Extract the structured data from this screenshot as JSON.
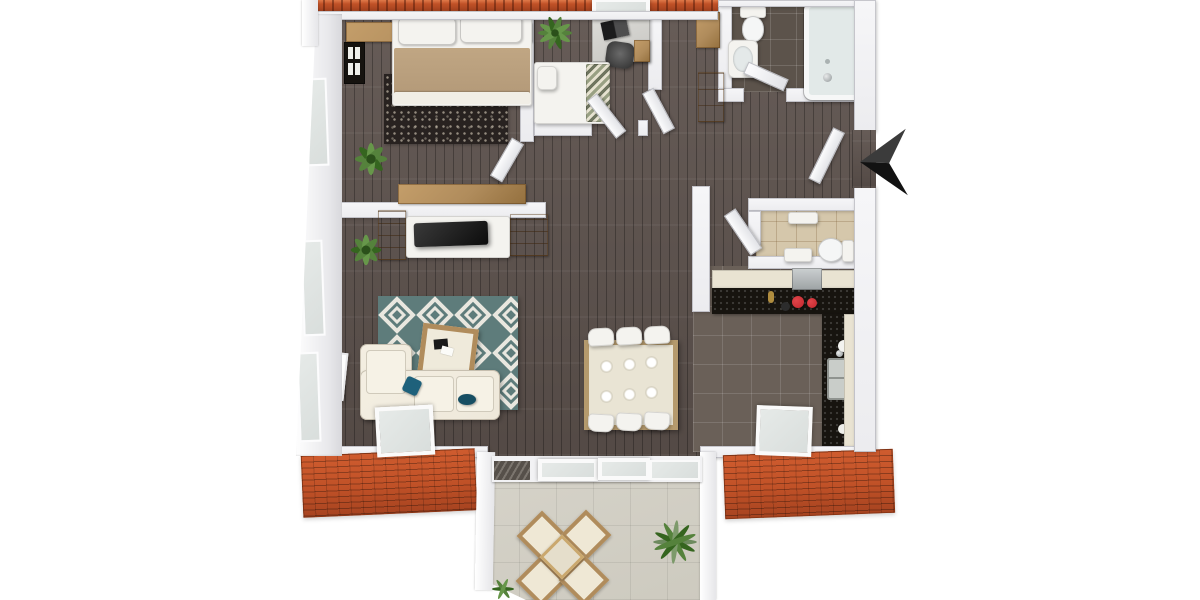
{
  "scene": {
    "type": "3d-floor-plan-render",
    "view": "top-down",
    "description": "3D rendered floor plan of an apartment with master bedroom, second bedroom with desk, hallway with wardrobes, bathroom with tub, separate WC, open kitchen with L-shaped black counter, open living-dining area and a tiled roof terrace with seating"
  },
  "colors": {
    "background": "#ffffff",
    "roof": "#c05127",
    "wall": "#ececef",
    "wood_floor": "#5d524d",
    "tile_bath": "#5c534b",
    "tile_kitchen": "#6a6058",
    "tile_wc": "#d5c7ab",
    "terrace_floor": "#cdcabf",
    "rug_teal": "#5e7c7b",
    "rug_cream": "#e9e7df",
    "rug_dark": "#282220",
    "sofa_cream": "#eee8da",
    "pillow_teal": "#1e617b",
    "blanket_tan": "#b49a79",
    "wood_furniture": "#b08c5c",
    "counter_black": "#17140f",
    "cabinet_cream": "#e9e3d2",
    "appliance_red": "#c2272d",
    "glass": "#d9dedc",
    "plant_green": "#55823c",
    "plant_green_dark": "#35651f",
    "plant_green_light": "#67974a",
    "arrow_black": "#121212",
    "art_pink": "#d4527e"
  },
  "rooms": [
    {
      "id": "bedroom-main",
      "floor": "dark-wood",
      "items": [
        "double-bed",
        "two-pillows",
        "tan-blanket",
        "black-white-patterned-rug",
        "wood-headboard-band",
        "wall-window-art",
        "plant",
        "sideboard"
      ]
    },
    {
      "id": "bedroom-2",
      "floor": "dark-wood",
      "items": [
        "single-bed",
        "zigzag-blanket",
        "desk",
        "laptop",
        "desk-chair",
        "drawer-unit",
        "plant"
      ]
    },
    {
      "id": "hallway",
      "floor": "dark-wood",
      "items": [
        "wardrobe-cabinet-upper",
        "wardrobe-cabinet-lower"
      ]
    },
    {
      "id": "bathroom",
      "floor": "dark-grey-tile",
      "items": [
        "toilet",
        "washbasin",
        "bathtub",
        "open-door"
      ]
    },
    {
      "id": "entrance",
      "floor": "dark-wood",
      "items": [
        "open-entrance-door",
        "entrance-direction-arrow"
      ]
    },
    {
      "id": "wc",
      "floor": "beige-tile",
      "items": [
        "toilet",
        "washbasin",
        "shelf",
        "open-door"
      ]
    },
    {
      "id": "kitchen",
      "floor": "grey-tile",
      "items": [
        "cream-cabinet-run",
        "black-countertop",
        "extractor-hood",
        "cooktop-with-red-pots",
        "side-counter-with-sink",
        "tall-cream-cabinet",
        "open-skylight-window"
      ]
    },
    {
      "id": "living-dining",
      "floor": "dark-wood",
      "items": [
        "corner-sofa",
        "teal-pillows",
        "teal-diamond-rug",
        "coffee-table",
        "tv-lowboard",
        "flat-tv",
        "media-shelves",
        "plant",
        "pink-wall-picture",
        "open-skylight-window",
        "dining-table",
        "six-plates",
        "six-chairs"
      ]
    },
    {
      "id": "terrace",
      "floor": "stone-tile",
      "items": [
        "four-armchairs",
        "side-table",
        "large-plant",
        "small-plant",
        "sliding-glass-doors"
      ]
    }
  ],
  "roofs": [
    "top-roof-strip",
    "top-roof-skylight",
    "lower-left-roof",
    "lower-right-roof"
  ],
  "indicators": {
    "entrance_arrow": "black arrow pointing at open entrance door on right side"
  }
}
